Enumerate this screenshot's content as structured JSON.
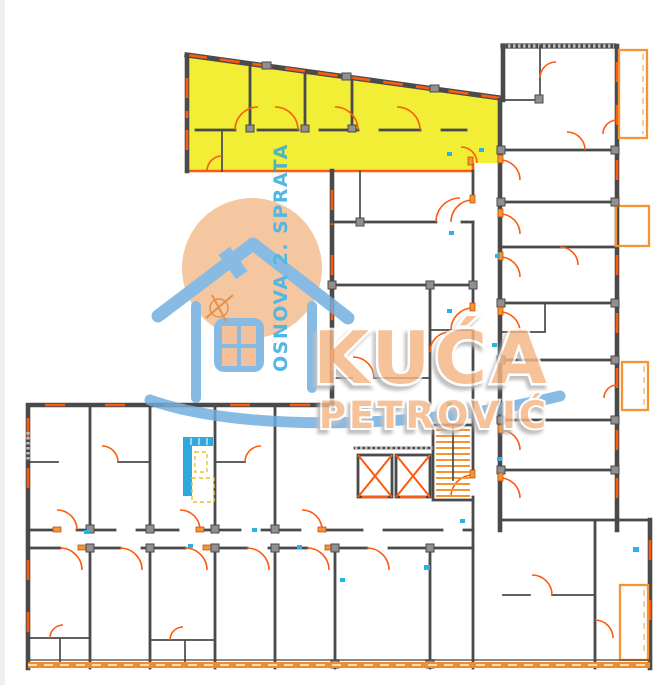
{
  "watermark": {
    "plan_label": "OSNOVA 2. SPRATA",
    "brand_line1": "KUĆA",
    "brand_line2": "PETROVIĆ",
    "circle_color": "#f2bb8c",
    "house_color": "#6fadde",
    "brand_fill": "#f5b585",
    "label_color": "#2ea7de"
  },
  "plan": {
    "highlight_color": "#f1ee35",
    "wall_color": "#4a4a4a",
    "accent_color": "#fd5a0f",
    "balcony_color": "#f59433",
    "marker_color": "#29b1e8",
    "staircase_count": 1,
    "elevator_count": 2
  }
}
